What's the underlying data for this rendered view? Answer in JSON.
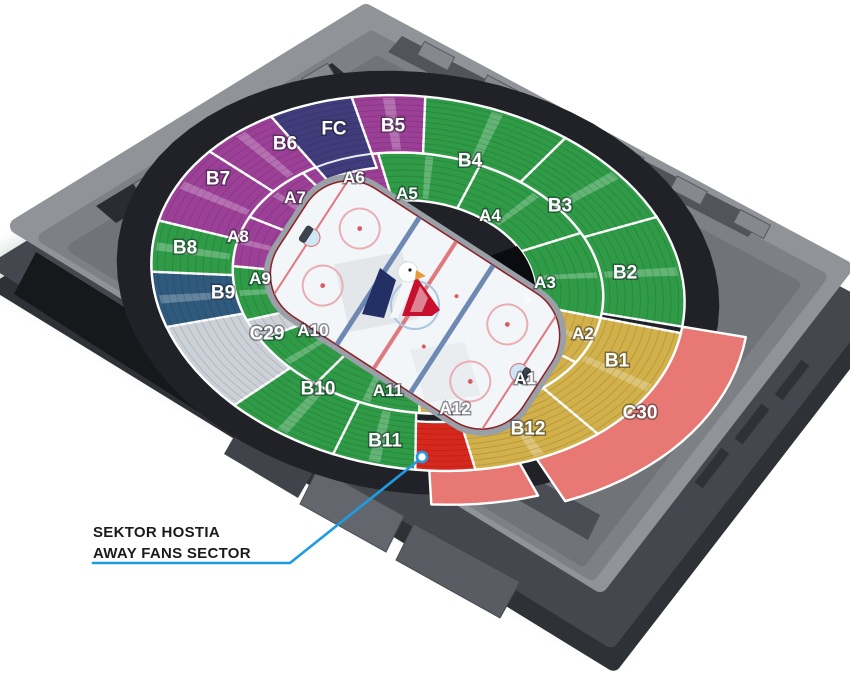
{
  "callout": {
    "line1": "SEKTOR HOSTIA",
    "line2": "AWAY FANS SECTOR",
    "color": "#1e9be4",
    "marker": [
      422,
      457
    ],
    "points": [
      [
        93,
        563
      ],
      [
        290,
        563
      ],
      [
        419,
        460
      ]
    ]
  },
  "icons": {
    "wheelchair": "♿",
    "logo": "hc-slovan-eagle-logo"
  },
  "colors": {
    "purple": "#9c4097",
    "indigo": "#413d7c",
    "green": "#2f9b47",
    "yellow": "#d2b04a",
    "steel_blue": "#2f5a7e",
    "flat_gray": "#ccd1d8",
    "salmon": "#e87873",
    "red": "#d7281e",
    "callout_blue": "#1e9be4"
  },
  "bowl": {
    "cx": 418,
    "cy": 283,
    "rx": 268,
    "ry": 186,
    "rot_deg": 8
  },
  "rink": {
    "cx": 415,
    "cy": 305,
    "rot_deg": 33,
    "half_w": 146,
    "half_h": 76
  },
  "sectors": [
    {
      "id": "C30",
      "label": "C30",
      "color": "salmon",
      "t0": 2,
      "t1": 58,
      "r0": 1.0,
      "r1": 1.24,
      "lx": 640,
      "ly": 412,
      "text_color": "#1d1d1f"
    },
    {
      "id": "C30B",
      "label": "",
      "color": "salmon",
      "t0": 62,
      "t1": 82,
      "r0": 1.0,
      "r1": 1.18,
      "lx": 0,
      "ly": 0
    },
    {
      "id": "C29",
      "label": "C29",
      "color": "flat_gray",
      "t0": 126,
      "t1": 185,
      "r0": 0.3,
      "r1": 1.0,
      "lx": 267,
      "ly": 333
    },
    {
      "id": "A2",
      "label": "A2",
      "color": "yellow",
      "t0": 4,
      "t1": 26,
      "r0": 0.44,
      "r1": 0.695,
      "lx": 583,
      "ly": 333
    },
    {
      "id": "A1",
      "label": "A1",
      "color": "yellow",
      "t0": 26,
      "t1": 55,
      "r0": 0.44,
      "r1": 0.695,
      "lx": 525,
      "ly": 378
    },
    {
      "id": "A12",
      "label": "A12",
      "color": "yellow",
      "t0": 55,
      "t1": 84,
      "r0": 0.44,
      "r1": 0.695,
      "lx": 455,
      "ly": 408
    },
    {
      "id": "A11",
      "label": "A11",
      "color": "green",
      "t0": 84,
      "t1": 118,
      "r0": 0.44,
      "r1": 0.695,
      "lx": 388,
      "ly": 390
    },
    {
      "id": "A10",
      "label": "A10",
      "color": "green",
      "t0": 118,
      "t1": 143,
      "r0": 0.44,
      "r1": 0.695,
      "lx": 313,
      "ly": 330
    },
    {
      "id": "A9",
      "label": "A9",
      "color": "green",
      "t0": 152,
      "t1": 176,
      "r0": 0.44,
      "r1": 0.695,
      "lx": 260,
      "ly": 278
    },
    {
      "id": "A8",
      "label": "A8",
      "color": "purple",
      "t0": 176,
      "t1": 199,
      "r0": 0.44,
      "r1": 0.695,
      "lx": 238,
      "ly": 236
    },
    {
      "id": "A7",
      "label": "A7",
      "color": "purple",
      "t0": -161,
      "t1": -134,
      "r0": 0.44,
      "r1": 0.695,
      "lx": 295,
      "ly": 197
    },
    {
      "id": "A6",
      "label": "A6",
      "color": "purple",
      "t0": -134,
      "t1": -108,
      "r0": 0.44,
      "r1": 0.695,
      "lx": 354,
      "ly": 177
    },
    {
      "id": "A5",
      "label": "A5",
      "color": "green",
      "t0": -108,
      "t1": -76,
      "r0": 0.44,
      "r1": 0.695,
      "lx": 407,
      "ly": 193
    },
    {
      "id": "A4",
      "label": "A4",
      "color": "green",
      "t0": -76,
      "t1": -34,
      "r0": 0.44,
      "r1": 0.695,
      "lx": 490,
      "ly": 215
    },
    {
      "id": "A3",
      "label": "A3",
      "color": "green",
      "t0": -34,
      "t1": 4,
      "r0": 0.44,
      "r1": 0.695,
      "lx": 545,
      "ly": 282
    },
    {
      "id": "B1",
      "label": "B1",
      "color": "yellow",
      "t0": 4,
      "t1": 42,
      "r0": 0.695,
      "r1": 1.0,
      "lx": 617,
      "ly": 360
    },
    {
      "id": "B12",
      "label": "B12",
      "color": "yellow",
      "t0": 42,
      "t1": 72,
      "r0": 0.695,
      "r1": 1.0,
      "lx": 528,
      "ly": 428
    },
    {
      "id": "B11",
      "label": "B11",
      "color": "green",
      "t0": 85,
      "t1": 103,
      "r0": 0.695,
      "r1": 1.0,
      "lx": 385,
      "ly": 440
    },
    {
      "id": "B10",
      "label": "B10",
      "color": "green",
      "t0": 103,
      "t1": 128,
      "r0": 0.695,
      "r1": 1.0,
      "lx": 318,
      "ly": 388
    },
    {
      "id": "B9",
      "label": "B9",
      "color": "steel_blue",
      "t0": 155,
      "t1": 172,
      "r0": 0.695,
      "r1": 1.0,
      "lx": 223,
      "ly": 292
    },
    {
      "id": "B8",
      "label": "B8",
      "color": "green",
      "t0": 172,
      "t1": 188,
      "r0": 0.695,
      "r1": 1.0,
      "lx": 185,
      "ly": 247
    },
    {
      "id": "B7",
      "label": "B7",
      "color": "purple",
      "t0": 188,
      "t1": 213,
      "r0": 0.695,
      "r1": 1.0,
      "lx": 218,
      "ly": 178
    },
    {
      "id": "B6",
      "label": "B6",
      "color": "purple",
      "t0": -147,
      "t1": -129,
      "r0": 0.695,
      "r1": 1.0,
      "lx": 285,
      "ly": 143
    },
    {
      "id": "B5",
      "label": "B5",
      "color": "purple",
      "t0": -110,
      "t1": -94,
      "r0": 0.695,
      "r1": 1.0,
      "lx": 393,
      "ly": 125
    },
    {
      "id": "B4",
      "label": "B4",
      "color": "green",
      "t0": -94,
      "t1": -62,
      "r0": 0.695,
      "r1": 1.0,
      "lx": 470,
      "ly": 160
    },
    {
      "id": "B3",
      "label": "B3",
      "color": "green",
      "t0": -62,
      "t1": -32,
      "r0": 0.695,
      "r1": 1.0,
      "lx": 560,
      "ly": 205
    },
    {
      "id": "B2",
      "label": "B2",
      "color": "green",
      "t0": -32,
      "t1": 2,
      "r0": 0.695,
      "r1": 1.0,
      "lx": 625,
      "ly": 272
    },
    {
      "id": "FC",
      "label": "FC",
      "color": "indigo",
      "t0": -129,
      "t1": -110,
      "r0": 0.62,
      "r1": 1.0,
      "lx": 334,
      "ly": 128
    },
    {
      "id": "AWAY",
      "label": "",
      "color": "red",
      "t0": 72,
      "t1": 85,
      "r0": 0.74,
      "r1": 1.0,
      "lx": 0,
      "ly": 0,
      "away": true
    }
  ]
}
